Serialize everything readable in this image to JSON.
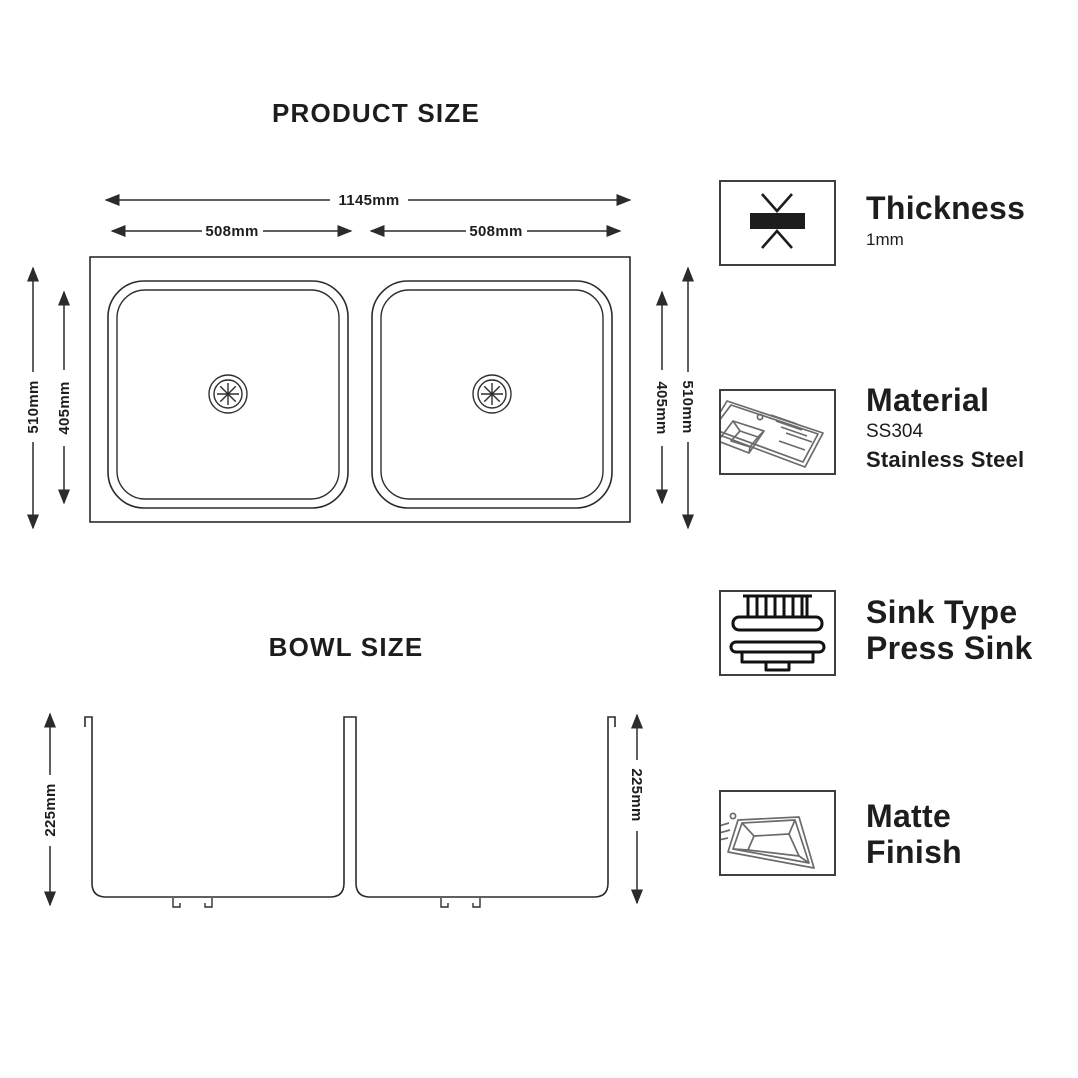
{
  "product_size": {
    "title": "PRODUCT SIZE",
    "overall_width": "1145mm",
    "left_bowl_width": "508mm",
    "right_bowl_width": "508mm",
    "left_outer_depth": "510mm",
    "left_inner_depth": "405mm",
    "right_inner_depth": "405mm",
    "right_outer_depth": "510mm"
  },
  "bowl_size": {
    "title": "BOWL SIZE",
    "left_depth": "225mm",
    "right_depth": "225mm"
  },
  "specs": [
    {
      "icon": "thickness-icon",
      "title": "Thickness",
      "value": "1mm"
    },
    {
      "icon": "material-icon",
      "title": "Material",
      "value": "SS304",
      "value2": "Stainless Steel"
    },
    {
      "icon": "press-sink-icon",
      "title": "Sink Type",
      "title2": "Press Sink"
    },
    {
      "icon": "matte-finish-icon",
      "title": "Matte",
      "title2": "Finish"
    }
  ],
  "colors": {
    "ink": "#1d1d1d",
    "drawing_line": "#2b2b2b",
    "icon_box_border": "#3f3f3f",
    "icon_gray": "#6b6b6b"
  }
}
